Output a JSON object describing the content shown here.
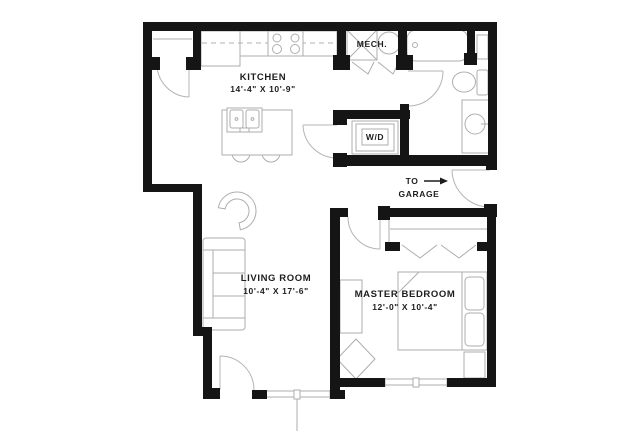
{
  "plan_title": "One-bedroom apartment floor plan",
  "rooms": {
    "kitchen": {
      "name": "KITCHEN",
      "dims": "14'-4\" X 10'-9\""
    },
    "living": {
      "name": "LIVING ROOM",
      "dims": "10'-4\" X 17'-6\""
    },
    "master": {
      "name": "MASTER BEDROOM",
      "dims": "12'-0\" X 10'-4\""
    },
    "mech": {
      "name": "MECH."
    },
    "laundry": {
      "name": "W/D"
    }
  },
  "annotations": {
    "garage_note": {
      "line1": "TO",
      "line2": "GARAGE",
      "arrow": "right-arrow"
    }
  },
  "colors": {
    "wall": "#151515",
    "fixture_line": "#aeaeae",
    "text": "#1d1d1d",
    "background": "#ffffff"
  }
}
